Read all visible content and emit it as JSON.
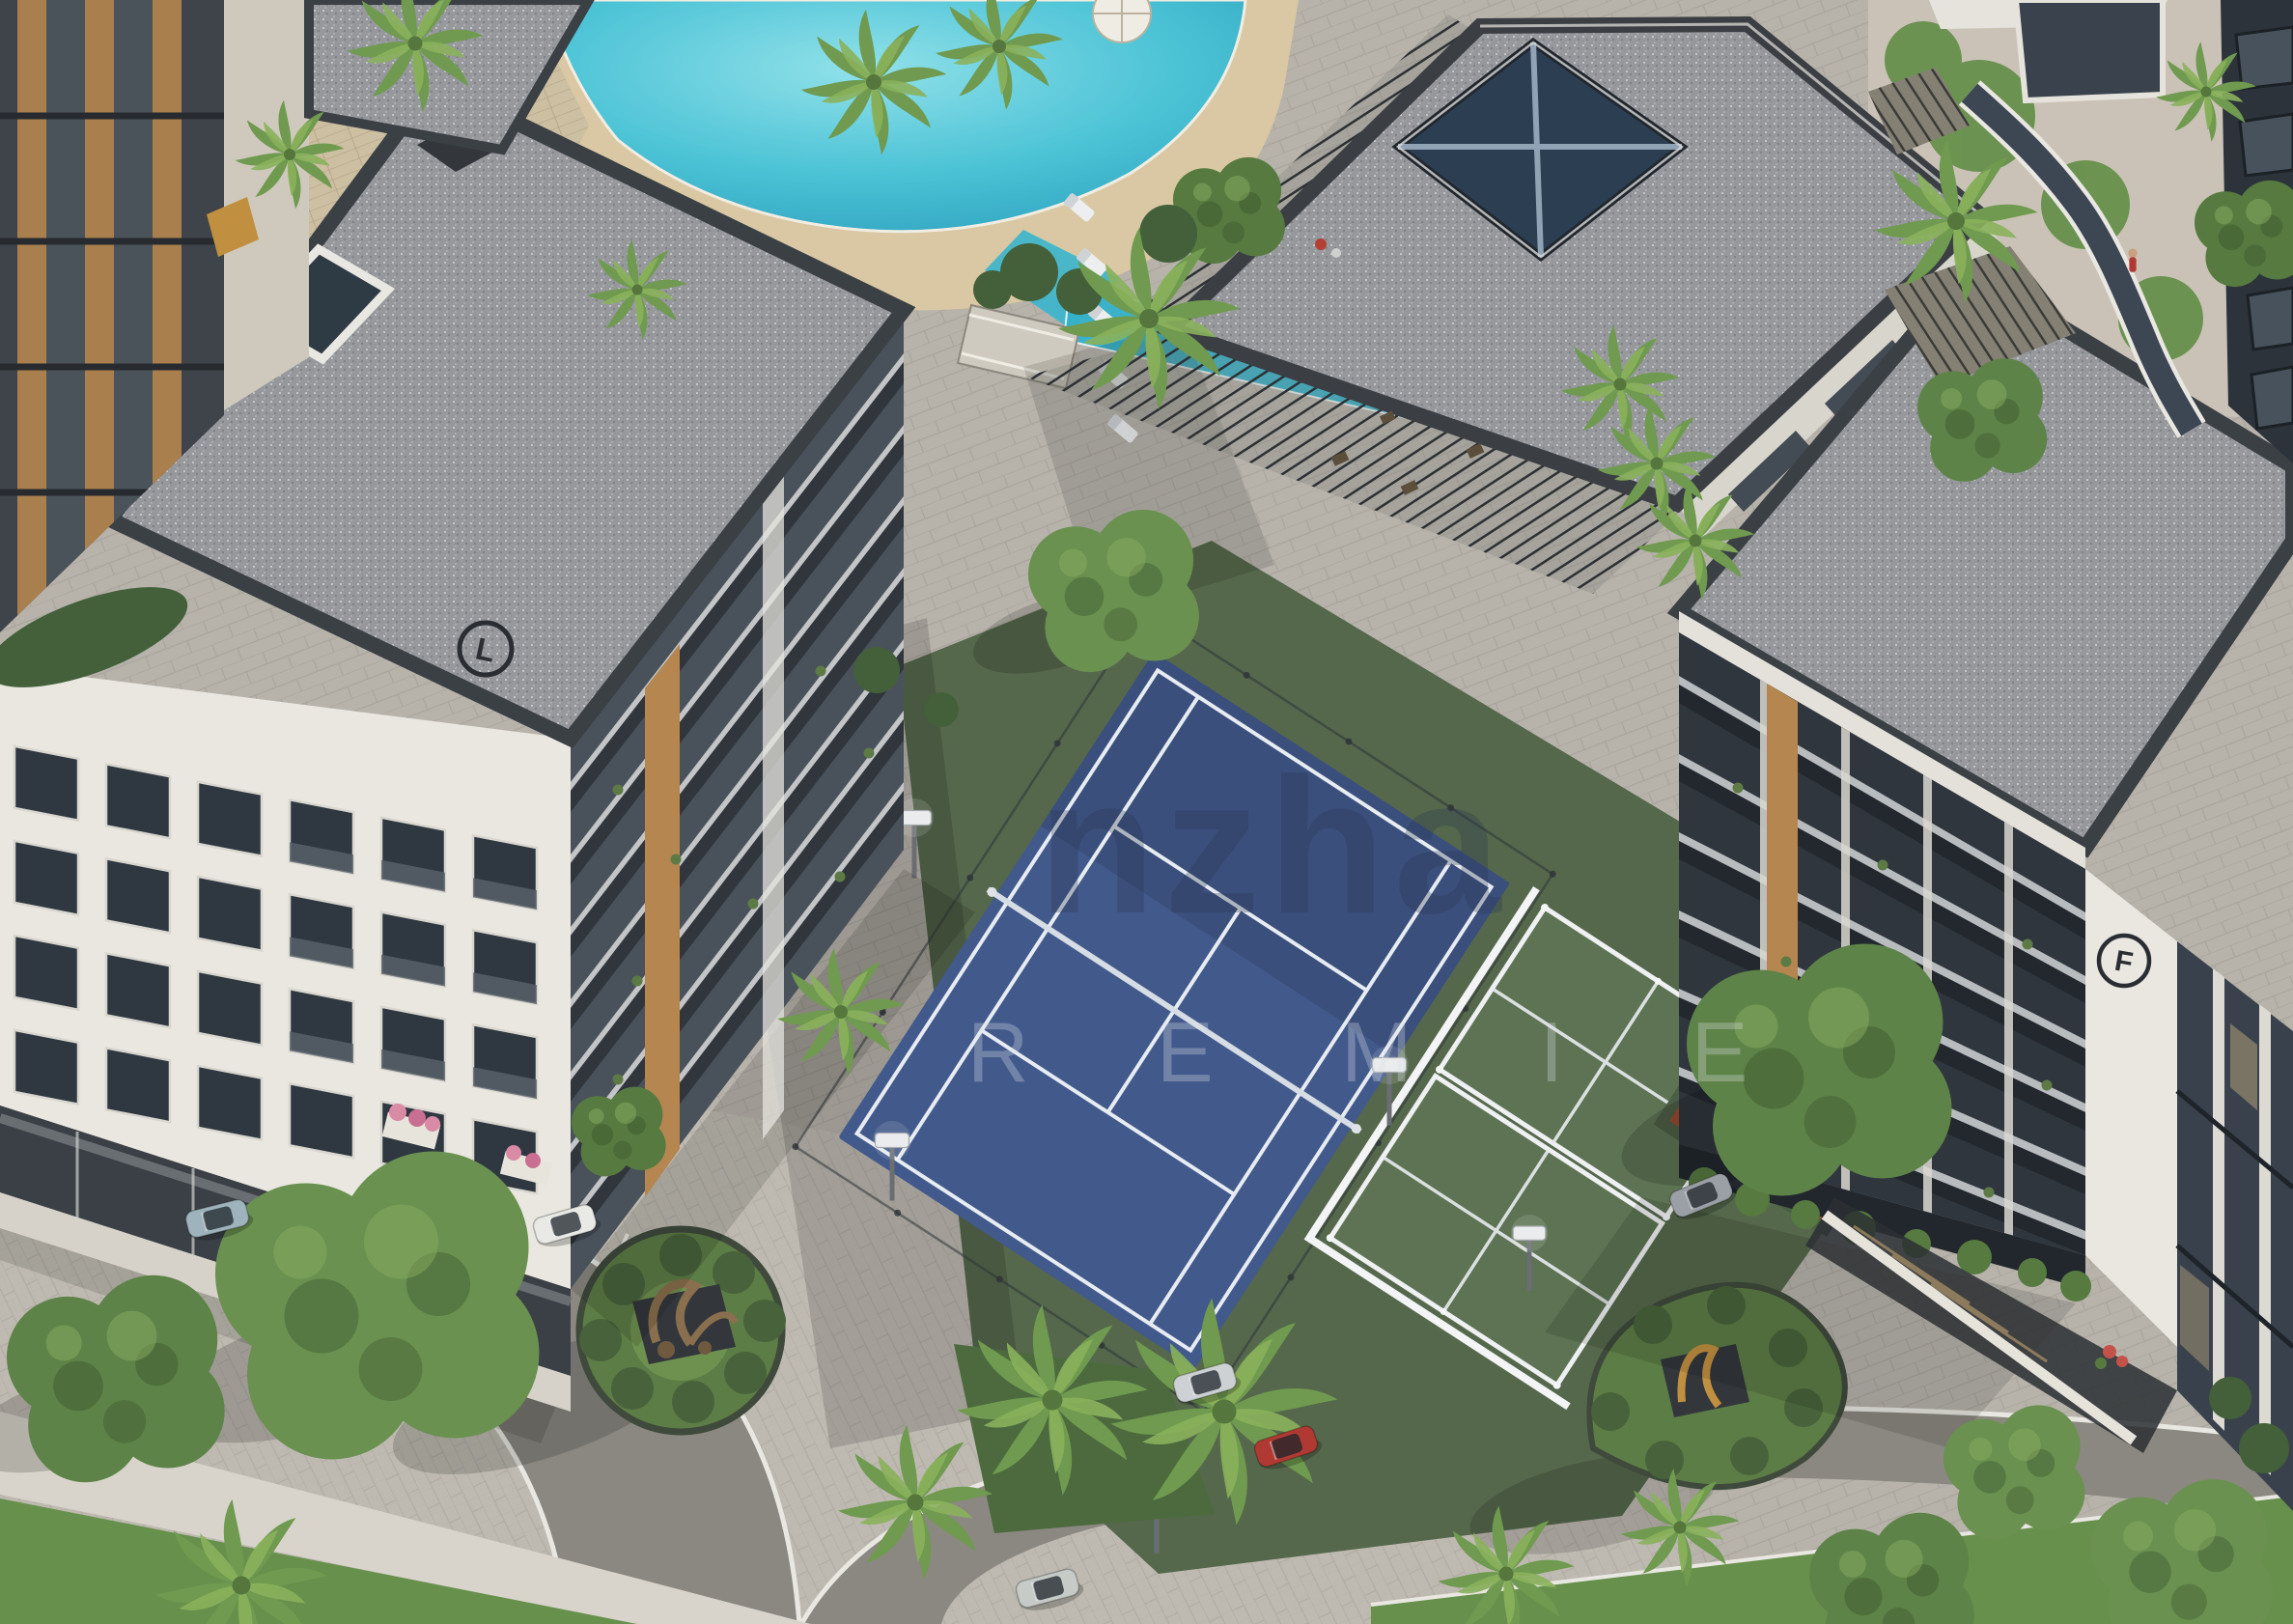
{
  "scene": {
    "title": "Aerial 3D rendering of a residential complex with lagoon pool, clubhouse, tennis and padel courts",
    "watermark": {
      "line1": "nzha",
      "line2": "R E M I E"
    }
  },
  "buildings": {
    "left_logo_letter": "L",
    "right_logo_letter": "F"
  },
  "colors": {
    "pavement": "#b7b3ab",
    "pavement2": "#bfbbb2",
    "road": "#8b8881",
    "curb": "#e9e7e1",
    "sidewalk": "#d8d4cb",
    "sand": "#d9c8a3",
    "deck": "#cdbfa2",
    "pool_light": "#8fe2ec",
    "pool_deep": "#2aa3c2",
    "lap_pool": "#35b2cb",
    "grass": "#67904c",
    "turf": "#55684c",
    "padel_turf": "#5d7354",
    "court_blue": "#42598b",
    "court_line": "#e7ecf2",
    "roof_gravel": "#96989c",
    "parapet": "#3b4045",
    "facade_white": "#e9e7e0",
    "glass_dark": "#39424c",
    "wood": "#b5864f",
    "tree_green": "#5e8348",
    "palm_green": "#74a04e",
    "hedge_green": "#43603a",
    "basketball": "#97492f",
    "sculpture_bronze": "#8a6f4e",
    "sculpture_gold": "#c09040",
    "watermark_dark": "#2a3850",
    "watermark_light": "#dfe4ea"
  },
  "cars": [
    {
      "name": "suv-blue-gray",
      "color": "#9eb3bc"
    },
    {
      "name": "sedan-white",
      "color": "#e9e9e6"
    },
    {
      "name": "pickup-silver",
      "color": "#cdd1d3"
    },
    {
      "name": "hatchback-red",
      "color": "#b03a33"
    },
    {
      "name": "sedan-silver-moving",
      "color": "#c6cbc8"
    },
    {
      "name": "sedan-gray",
      "color": "#9aa0a5"
    }
  ]
}
